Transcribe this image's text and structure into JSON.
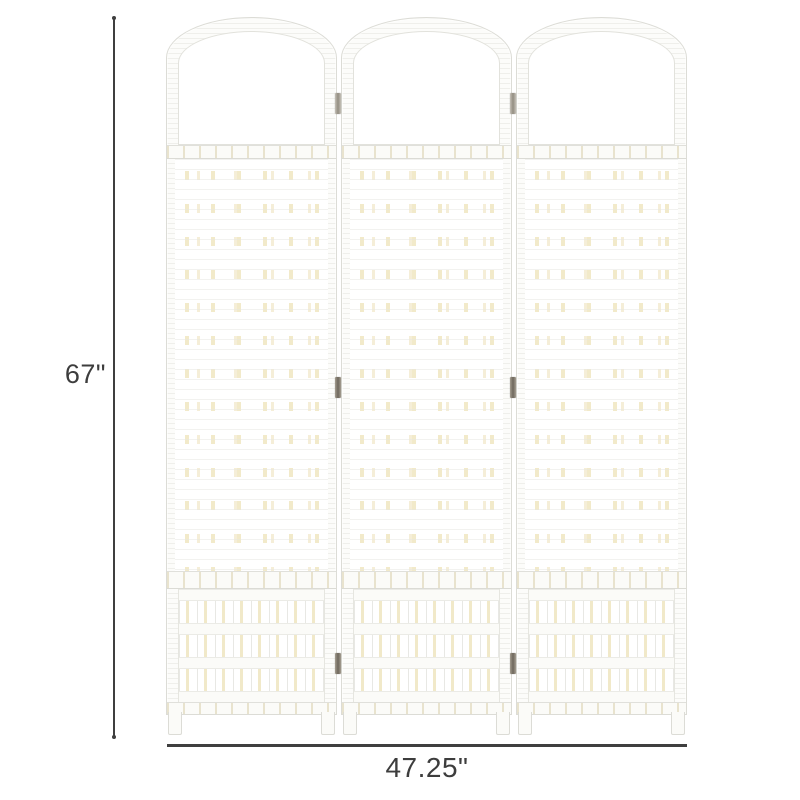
{
  "product": {
    "name": "3-panel wicker folding room divider",
    "panel_count": 3,
    "panel_style": "arched top, open woven lattice top and bottom, tight weave center"
  },
  "dimensions": {
    "height_label": "67\"",
    "width_label": "47.25\""
  },
  "colors": {
    "background": "#ffffff",
    "dimension_line": "#3f3f3f",
    "dimension_text": "#3d3d3d",
    "panel_white": "#fcfcfa",
    "frame_outline": "#dcdcd6",
    "wicker_cream": "#f1e9c9",
    "hinge_metal": "#6e675c"
  }
}
